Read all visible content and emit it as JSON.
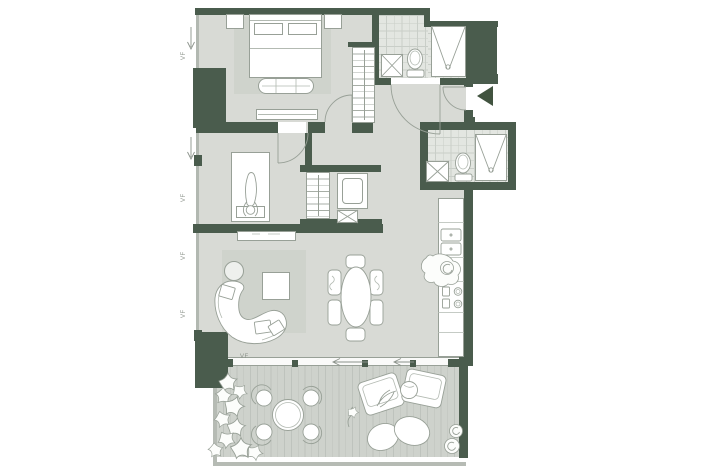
{
  "plan": {
    "annotations": {
      "window_label": "VF"
    },
    "icons": {
      "entry_arrow": "solid-left-triangle",
      "window_swing_arrow": "thin-down-arrow",
      "slide_arrow": "thin-left-arrow"
    },
    "colors": {
      "paper": "#ffffff",
      "wall": "#4a5c4d",
      "wall_dark": "#41533f",
      "floor": "#d8dad5",
      "rug": "#cfd3cc",
      "tile": "#e3e6e1",
      "tile_line": "#c9cec8",
      "deck": "#ced2cc",
      "deck_line": "#bec3bd",
      "parapet": "#b6bbb4",
      "glazing": "#b2b8b1",
      "line": "#98a097",
      "line_light": "#b3bab2",
      "furn": "#ffffff",
      "anno": "#8b928a"
    }
  }
}
